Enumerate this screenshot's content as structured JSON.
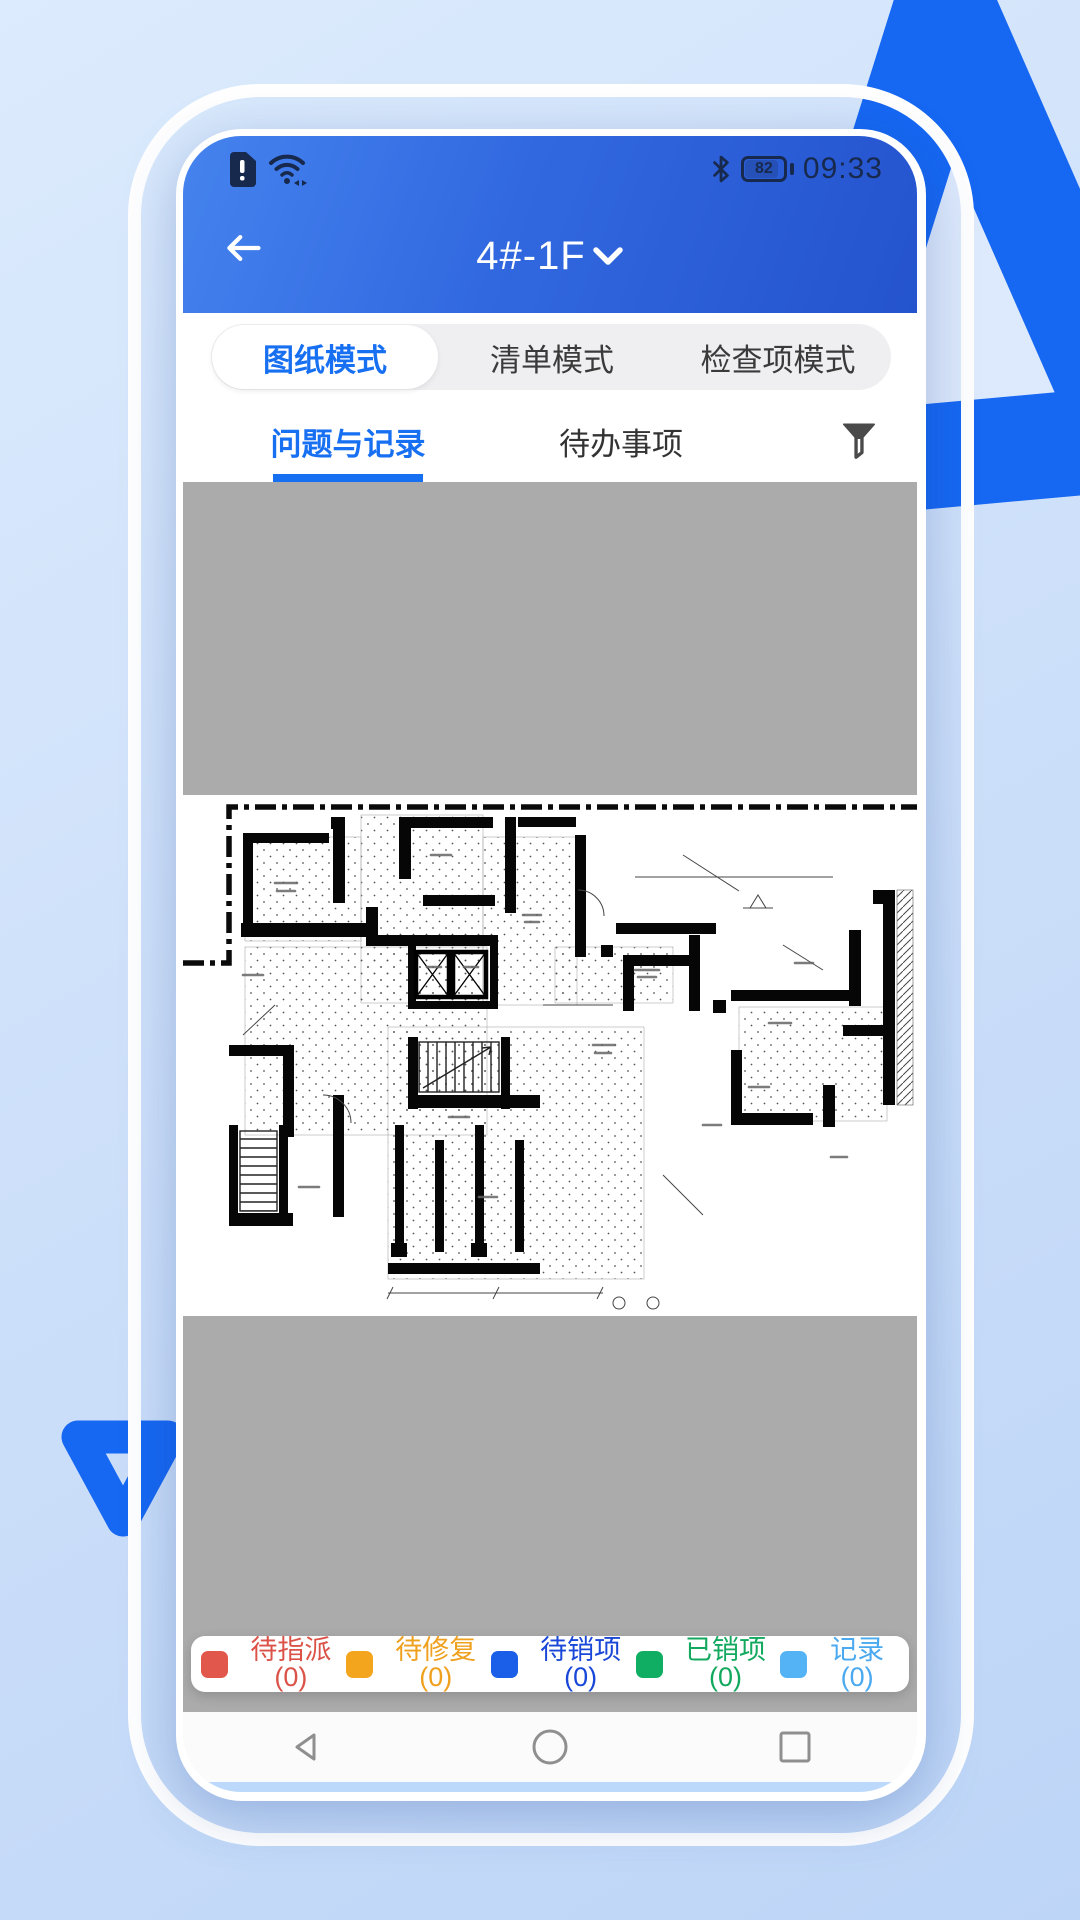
{
  "status_bar": {
    "time": "09:33",
    "battery_percent": "82",
    "icons": [
      "sim-alert-icon",
      "wifi-icon",
      "bluetooth-icon",
      "battery-icon"
    ]
  },
  "header": {
    "title": "4#-1F",
    "back_icon": "arrow-left-icon",
    "dropdown_icon": "chevron-down-icon"
  },
  "mode_tabs": {
    "items": [
      {
        "label": "图纸模式",
        "active": true
      },
      {
        "label": "清单模式",
        "active": false
      },
      {
        "label": "检查项模式",
        "active": false
      }
    ]
  },
  "sub_tabs": {
    "items": [
      {
        "label": "问题与记录",
        "active": true
      },
      {
        "label": "待办事项",
        "active": false
      }
    ],
    "filter_icon": "funnel-icon"
  },
  "legend": {
    "items": [
      {
        "label": "待指派(0)",
        "color": "#E2574B",
        "text_color": "#DB5348"
      },
      {
        "label": "待修复(0)",
        "color": "#F2A51D",
        "text_color": "#EFA01E"
      },
      {
        "label": "待销项(0)",
        "color": "#1B5FE8",
        "text_color": "#1947D8"
      },
      {
        "label": "已销项(0)",
        "color": "#0FAE63",
        "text_color": "#12A95F"
      },
      {
        "label": "记录(0)",
        "color": "#54B3F4",
        "text_color": "#4AA9EF"
      }
    ]
  },
  "nav_bar": {
    "icons": [
      "triangle-back-icon",
      "circle-home-icon",
      "square-recents-icon"
    ]
  },
  "colors": {
    "accent": "#176FF2",
    "header_gradient_start": "#4583EE",
    "header_gradient_end": "#2453CD",
    "placeholder_gray": "#ABABAB",
    "decor_blue": "#1667F2",
    "status_icon_navy": "#18294E"
  }
}
